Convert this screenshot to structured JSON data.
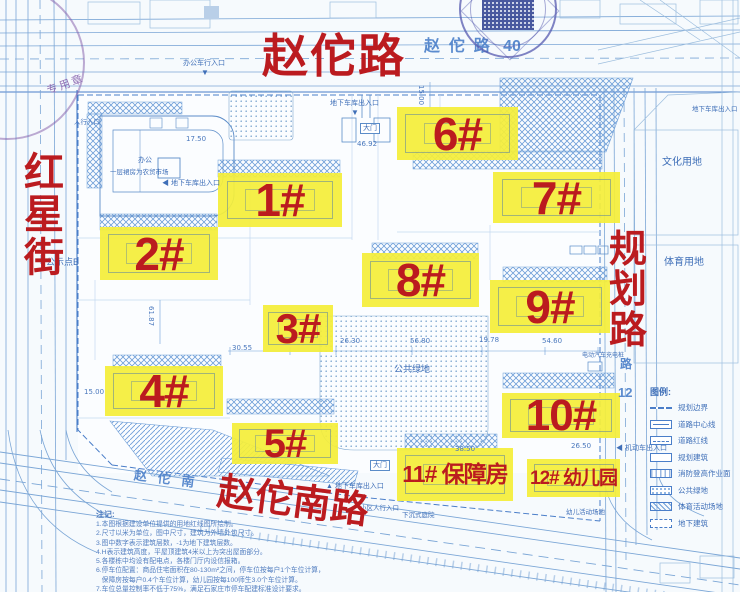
{
  "colors": {
    "highlight": "#f4ee3a",
    "label_red": "#bb1b1f",
    "blueprint_line": "#6f9fd8",
    "text_blue": "#3f6fb8",
    "stamp_blue": "#4a55a8",
    "stamp_purple": "#8058a8"
  },
  "roads": {
    "top_red": "赵佗路",
    "left_red_chars": [
      "红",
      "星",
      "街"
    ],
    "right_red_chars": [
      "规",
      "划",
      "路"
    ],
    "bottom_red": "赵佗南路",
    "top_blue": "赵  佗  路   40",
    "bottom_blue": "赵   佗   南",
    "right_blue_char": "路",
    "right_blue_num": "12"
  },
  "stamps": {
    "left_text": "专用章"
  },
  "buildings": [
    {
      "label": "1#",
      "x": 218,
      "y": 173,
      "w": 124,
      "h": 54,
      "fs": 46
    },
    {
      "label": "2#",
      "x": 100,
      "y": 227,
      "w": 118,
      "h": 53,
      "fs": 46
    },
    {
      "label": "3#",
      "x": 263,
      "y": 305,
      "w": 70,
      "h": 47,
      "fs": 42
    },
    {
      "label": "4#",
      "x": 105,
      "y": 366,
      "w": 118,
      "h": 50,
      "fs": 46
    },
    {
      "label": "5#",
      "x": 232,
      "y": 423,
      "w": 106,
      "h": 41,
      "fs": 40
    },
    {
      "label": "6#",
      "x": 397,
      "y": 107,
      "w": 121,
      "h": 53,
      "fs": 46
    },
    {
      "label": "7#",
      "x": 493,
      "y": 172,
      "w": 127,
      "h": 51,
      "fs": 46
    },
    {
      "label": "8#",
      "x": 362,
      "y": 253,
      "w": 117,
      "h": 54,
      "fs": 46
    },
    {
      "label": "9#",
      "x": 490,
      "y": 280,
      "w": 120,
      "h": 53,
      "fs": 46
    },
    {
      "label": "10#",
      "x": 502,
      "y": 393,
      "w": 118,
      "h": 45,
      "fs": 44
    },
    {
      "label": "11# 保障房",
      "x": 397,
      "y": 448,
      "w": 116,
      "h": 53,
      "fs": 23
    },
    {
      "label": "12# 幼儿园",
      "x": 527,
      "y": 459,
      "w": 93,
      "h": 38,
      "fs": 19
    }
  ],
  "site_labels": [
    {
      "text": "文化用地",
      "x": 662,
      "y": 157,
      "fs": 10
    },
    {
      "text": "体育用地",
      "x": 664,
      "y": 257,
      "fs": 10
    },
    {
      "text": "公共绿地",
      "x": 394,
      "y": 365,
      "fs": 9
    },
    {
      "text": "公示点B",
      "x": 46,
      "y": 258,
      "fs": 9
    },
    {
      "text": "办公车行入口",
      "x": 183,
      "y": 60,
      "fs": 7
    },
    {
      "text": "▼",
      "x": 201,
      "y": 69,
      "fs": 8
    },
    {
      "text": "地下车库出入口",
      "x": 330,
      "y": 100,
      "fs": 7
    },
    {
      "text": "▼",
      "x": 351,
      "y": 109,
      "fs": 8
    },
    {
      "text": "大门",
      "x": 360,
      "y": 123,
      "fs": 7,
      "box": true
    },
    {
      "text": "◀ 地下车库出入口",
      "x": 162,
      "y": 180,
      "fs": 7
    },
    {
      "text": "人行入口",
      "x": 74,
      "y": 119,
      "fs": 6.5
    },
    {
      "text": "办公",
      "x": 138,
      "y": 157,
      "fs": 7
    },
    {
      "text": "一层裙房为农贸市场",
      "x": 110,
      "y": 169,
      "fs": 6.5
    },
    {
      "text": "大门",
      "x": 370,
      "y": 460,
      "fs": 7,
      "box": true
    },
    {
      "text": "▲ 地下车库出入口",
      "x": 326,
      "y": 483,
      "fs": 7
    },
    {
      "text": "小区人行入口",
      "x": 360,
      "y": 505,
      "fs": 6.5
    },
    {
      "text": "下沉式庭院",
      "x": 402,
      "y": 512,
      "fs": 6.5
    },
    {
      "text": "幼儿活动场地",
      "x": 566,
      "y": 509,
      "fs": 6.5
    },
    {
      "text": "◀ 机动车出入口",
      "x": 616,
      "y": 445,
      "fs": 7
    },
    {
      "text": "电动汽车充电桩",
      "x": 582,
      "y": 353,
      "fs": 6
    },
    {
      "text": "地下车库出入口",
      "x": 692,
      "y": 106,
      "fs": 6.5
    }
  ],
  "dims": [
    {
      "text": "17.50",
      "x": 186,
      "y": 135
    },
    {
      "text": "46.92",
      "x": 357,
      "y": 140
    },
    {
      "text": "15.00",
      "x": 425,
      "y": 85,
      "rot": true
    },
    {
      "text": "15.00",
      "x": 84,
      "y": 388
    },
    {
      "text": "30.55",
      "x": 232,
      "y": 344
    },
    {
      "text": "26.30",
      "x": 340,
      "y": 337
    },
    {
      "text": "56.80",
      "x": 410,
      "y": 337
    },
    {
      "text": "19.78",
      "x": 479,
      "y": 336
    },
    {
      "text": "54.60",
      "x": 542,
      "y": 337
    },
    {
      "text": "38.50",
      "x": 455,
      "y": 445
    },
    {
      "text": "26.50",
      "x": 571,
      "y": 442
    },
    {
      "text": "61.87",
      "x": 155,
      "y": 306,
      "rot": true
    }
  ],
  "legend": {
    "title": "图例:",
    "items": [
      {
        "label": "规划边界",
        "sym": "boundary"
      },
      {
        "label": "道路中心线",
        "sym": "centerline"
      },
      {
        "label": "道路红线",
        "sym": "redline"
      },
      {
        "label": "规划建筑",
        "sym": "building"
      },
      {
        "label": "消防登高作业面",
        "sym": "fire"
      },
      {
        "label": "公共绿地",
        "sym": "green"
      },
      {
        "label": "体育活动场地",
        "sym": "sport"
      },
      {
        "label": "地下建筑",
        "sym": "underground"
      }
    ]
  },
  "notes": {
    "title": "注记:",
    "lines": [
      "1.本图根据建设单位提供的用地红线图所绘制。",
      "2.尺寸以米为单位，图中尺寸，建筑为外墙外包尺寸。",
      "3.图中数字表示建筑层数，-1为地下建筑层数。",
      "4.H表示建筑高度，平屋顶建筑4米以上为突出屋面部分。",
      "5.各楼栋中均设有配电点，各楼门厅内设信报箱。",
      "6.停车位配置：商品住宅面积在80-130m²之间，停车位按每户1个车位计算，",
      "   保障房按每户0.4个车位计算，幼儿园按每100师生3.0个车位计算。",
      "7.车位总量控制率不低于75%，满足石家庄市停车配建标准设计要求。"
    ]
  }
}
